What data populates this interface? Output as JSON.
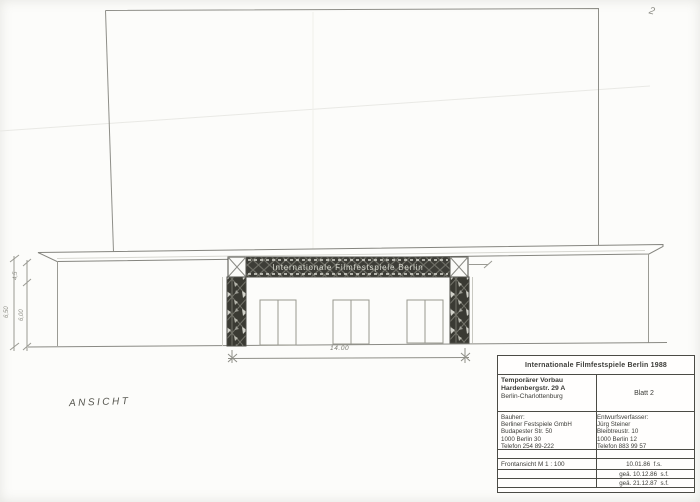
{
  "page": {
    "corner_mark": "2"
  },
  "drawing": {
    "view_label": "ANSICHT",
    "banner_text": "Internationale Filmfestspiele Berlin",
    "dim_width": "14.00",
    "dim_h1": "4,5",
    "dim_h2": "6,50",
    "dim_h3": "6,00"
  },
  "title_block": {
    "header": "Internationale Filmfestspiele Berlin 1988",
    "project_line1": "Temporärer Vorbau",
    "project_line2": "Hardenbergstr. 29 A",
    "project_line3": "Berlin-Charlottenburg",
    "sheet": "Blatt 2",
    "client_label": "Bauherr:",
    "client_name": "Berliner Festspiele GmbH",
    "client_street": "Budapester Str. 50",
    "client_city": "1000 Berlin 30",
    "client_phone": "Telefon 254 89-222",
    "designer_label": "Entwurfsverfasser:",
    "designer_name": "Jürg Steiner",
    "designer_street": "Bleibtreustr. 10",
    "designer_city": "1000 Berlin 12",
    "designer_phone": "Telefon 883 99 57",
    "scale_label": "Frontansicht M 1 : 100",
    "date1": "10.01.86  f.s.",
    "date2": "geä. 10.12.86  s.f.",
    "date3": "geä. 21.12.87  s.f."
  }
}
